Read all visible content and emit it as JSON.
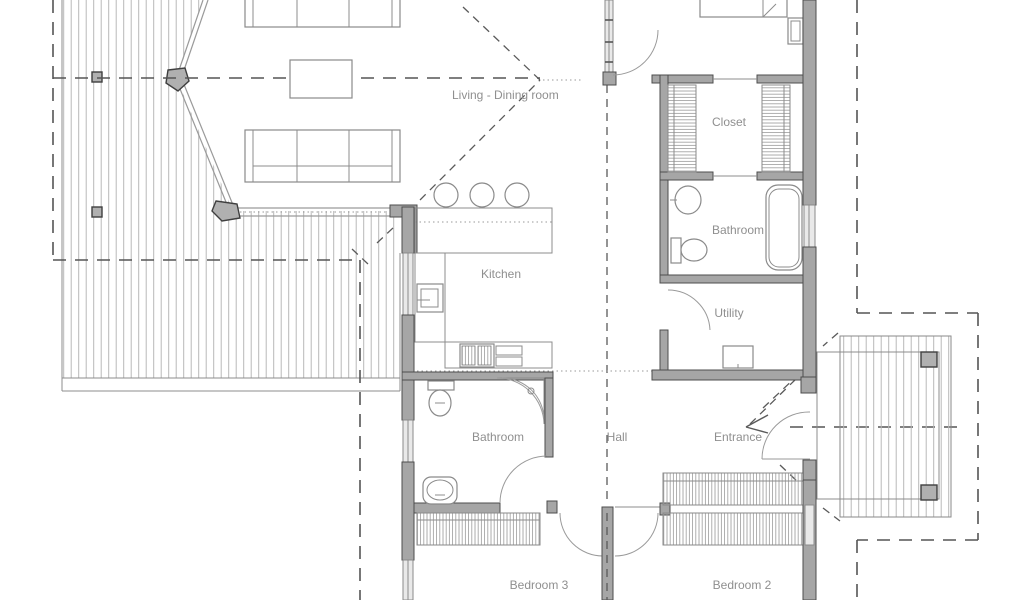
{
  "figure": {
    "type": "architectural-floor-plan"
  },
  "palette": {
    "background": "#ffffff",
    "wall_fill": "#a6a6a6",
    "wall_stroke": "#4d4d4d",
    "window_fill": "#e9e9e9",
    "thin_line": "#8c8c8c",
    "deck_line": "#b8b8b8",
    "dash_line": "#555555",
    "label_text": "#8f8f8f"
  },
  "rooms": {
    "living_dining": "Living - Dining room",
    "closet": "Closet",
    "bathroom_top": "Bathroom",
    "kitchen": "Kitchen",
    "utility": "Utility",
    "hall": "Hall",
    "entrance": "Entrance",
    "bathroom_bottom": "Bathroom",
    "bedroom_3": "Bedroom 3",
    "bedroom_2": "Bedroom 2"
  }
}
